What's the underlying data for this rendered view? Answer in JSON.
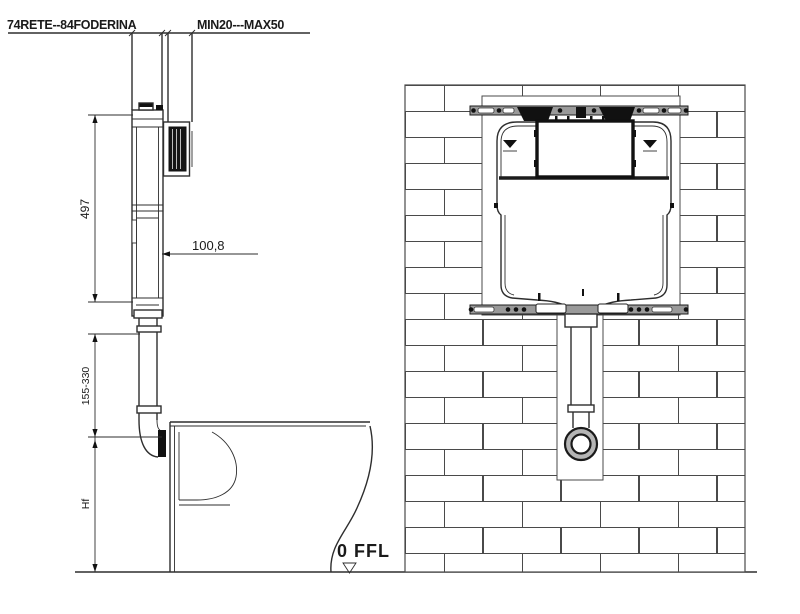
{
  "dimensions": {
    "embed_depth": "74RETE--84FODERINA",
    "plate_offset": "MIN20---MAX50",
    "tank_height": "497",
    "tank_depth": "100,8",
    "pipe_height_range": "155-330",
    "pan_height": "Hf",
    "floor_level": "0 FFL"
  },
  "colors": {
    "line": "#2e2e2e",
    "brick_line": "#4a4a4a",
    "rail": "#9a9a9a",
    "panel": "#111111",
    "outlet_ring": "#b5b5b5"
  }
}
